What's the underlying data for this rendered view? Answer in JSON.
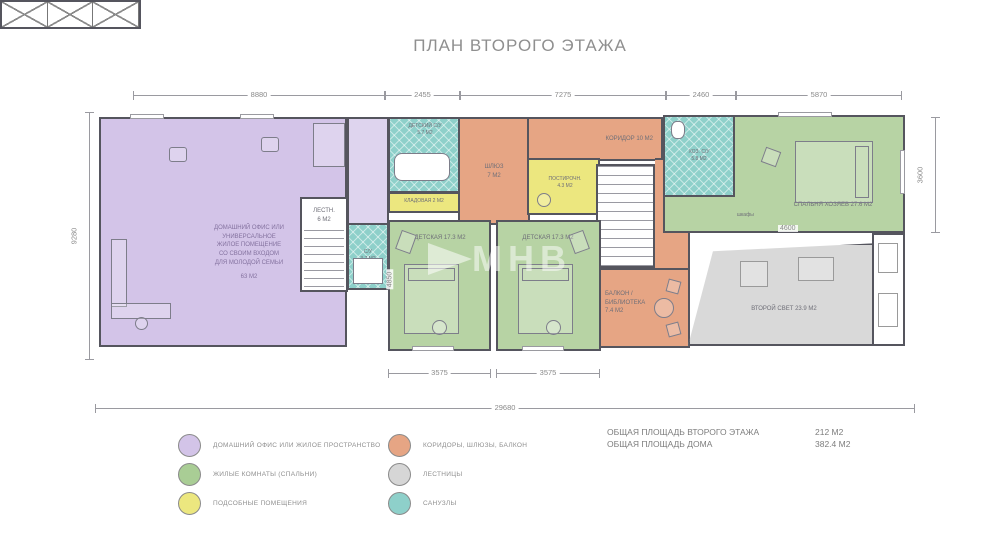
{
  "title": "ПЛАН ВТОРОГО ЭТАЖА",
  "watermark": {
    "text": "МНВ"
  },
  "rooms": {
    "home_office": {
      "label": "ДОМАШНИЙ ОФИС ИЛИ\nУНИВЕРСАЛЬНОЕ\nЖИЛОЕ ПОМЕЩЕНИЕ\nСО СВОИМ ВХОДОМ\nДЛЯ МОЛОДОЙ СЕМЬИ",
      "area": "63 М2"
    },
    "stairs_small": {
      "label": "ЛЕСТН.\n6 М2"
    },
    "kids_bath": {
      "label": "ДЕТСКИЙ С/У\n5.7 М2"
    },
    "storage": {
      "label": "КЛАДОВАЯ 2 М2"
    },
    "su": {
      "label": "С/У\n3.7 М2"
    },
    "shluz": {
      "label": "ШЛЮЗ\n7 М2"
    },
    "laundry": {
      "label": "ПОСТИРОЧН.\n4.3 М2"
    },
    "corridor": {
      "label": "КОРИДОР 10 М2"
    },
    "kids1": {
      "label": "ДЕТСКАЯ 17.3 М2"
    },
    "kids2": {
      "label": "ДЕТСКАЯ 17.3 М2"
    },
    "balcony": {
      "label": "БАЛКОН /\nБИБЛИОТЕКА\n7.4 М2"
    },
    "master_bath": {
      "label": "ХОЗ. С/У\n5.8 М2"
    },
    "master_bedroom": {
      "label": "СПАЛЬНЯ ХОЗЯЕВ 27.6 М2"
    },
    "wardrobe": {
      "label": "шкафы"
    },
    "second_light": {
      "label": "ВТОРОЙ СВЕТ 23.9 М2"
    }
  },
  "dims": {
    "top": [
      "8880",
      "2455",
      "7275",
      "2460",
      "5870"
    ],
    "left": "9280",
    "right": "3600",
    "bottom": [
      "3575",
      "3575"
    ],
    "total": "29680",
    "kids_depth": "4850",
    "wardrobe_width": "4600"
  },
  "legend": {
    "left": [
      {
        "label": "ДОМАШНИЙ ОФИС ИЛИ ЖИЛОЕ ПРОСТРАНСТВО",
        "color": "#d3c4e8"
      },
      {
        "label": "ЖИЛЫЕ КОМНАТЫ (СПАЛЬНИ)",
        "color": "#a9cd95"
      },
      {
        "label": "ПОДСОБНЫЕ ПОМЕЩЕНИЯ",
        "color": "#ece77f"
      }
    ],
    "right": [
      {
        "label": "КОРИДОРЫ, ШЛЮЗЫ, БАЛКОН",
        "color": "#e6a584"
      },
      {
        "label": "ЛЕСТНИЦЫ",
        "color": "#d6d6d6"
      },
      {
        "label": "САНУЗЛЫ",
        "color": "#8ed0ca"
      }
    ]
  },
  "summary": {
    "rows": [
      {
        "label": "ОБЩАЯ ПЛОЩАДЬ ВТОРОГО ЭТАЖА",
        "value": "212 М2"
      },
      {
        "label": "ОБЩАЯ ПЛОЩАДЬ ДОМА",
        "value": "382.4 М2"
      }
    ]
  },
  "colors": {
    "purple": "#d3c4e8",
    "green": "#b7d3a4",
    "yellow": "#ece77f",
    "orange": "#e6a584",
    "gray": "#d9d9d9",
    "teal": "#8ed0ca",
    "wall": "#55555e"
  }
}
